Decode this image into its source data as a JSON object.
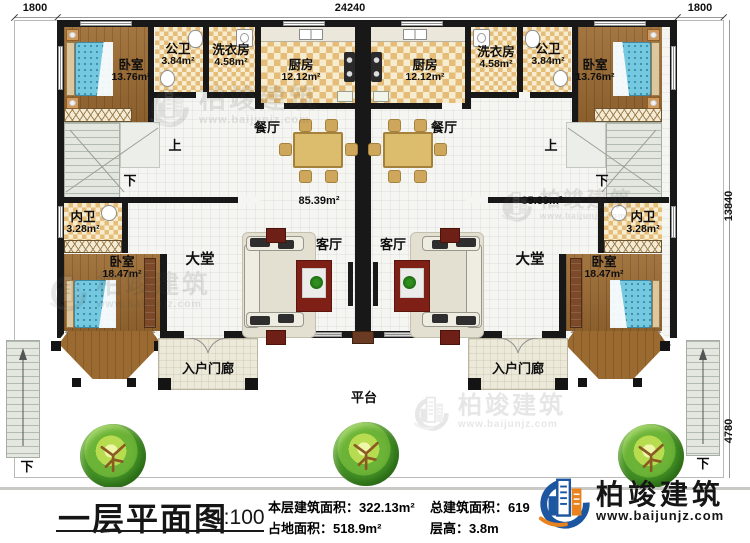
{
  "dimensions": {
    "top_left": "1800",
    "top_center": "24240",
    "top_right": "1800",
    "right_upper": "13840",
    "right_lower": "4780"
  },
  "rooms": {
    "bedroom_front": {
      "name": "卧室",
      "area": "13.76m²"
    },
    "public_bath": {
      "name": "公卫",
      "area": "3.84m²"
    },
    "laundry": {
      "name": "洗衣房",
      "area": "4.58m²"
    },
    "kitchen": {
      "name": "厨房",
      "area": "12.12m²"
    },
    "inner_bath": {
      "name": "内卫",
      "area": "3.28m²"
    },
    "bedroom_rear": {
      "name": "卧室",
      "area": "18.47m²"
    },
    "dining": "餐厅",
    "living": "客厅",
    "hall": "大堂",
    "unit_area": "85.39m²",
    "porch": "入户门廊",
    "platform": "平台",
    "stair_up": "上",
    "stair_down": "下"
  },
  "title_block": {
    "title": "一层平面图",
    "scale": "1:100",
    "stats": [
      {
        "label": "本层建筑面积：",
        "value": "322.13m²"
      },
      {
        "label": "占地面积：",
        "value": "518.9m²"
      },
      {
        "label": "总建筑面积：",
        "value": "619"
      },
      {
        "label": "层高：",
        "value": "3.8m"
      }
    ]
  },
  "brand": {
    "name": "柏竣建筑",
    "url": "www.baijunjz.com"
  }
}
